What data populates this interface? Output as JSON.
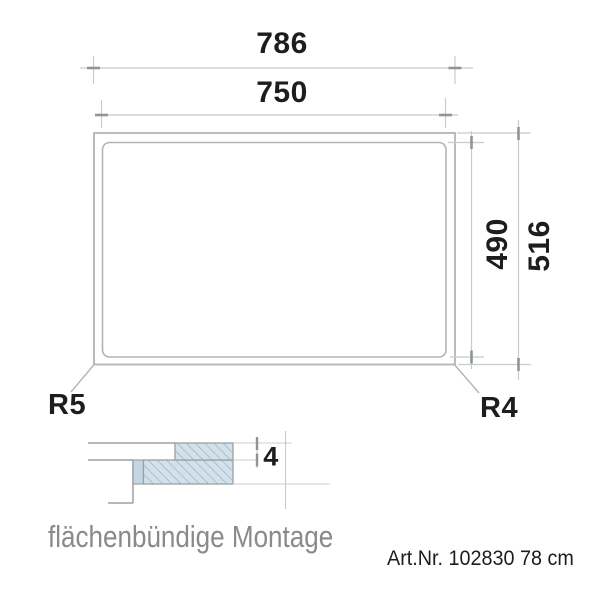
{
  "drawing": {
    "dim_outer_width": "786",
    "dim_cutout_width": "750",
    "dim_cutout_height": "490",
    "dim_outer_height": "516",
    "radius_left": "R5",
    "radius_right": "R4",
    "dim_glass_thickness": "4",
    "caption": "flächenbündige Montage",
    "art_no": "Art.Nr. 102830 78 cm"
  },
  "dimensions_mm": {
    "outer_width": 786,
    "cutout_width": 750,
    "cutout_height": 490,
    "outer_height": 516,
    "corner_radius_left": 5,
    "corner_radius_right": 4,
    "glass_thickness": 4
  },
  "colors": {
    "drawing_line": "#b1b5b8",
    "dim_line": "#c8cccf",
    "tick": "#8f9496",
    "section_line": "#9aa0a3",
    "hatch_fill": "#d3e1ea",
    "hatch_line": "#93abbd",
    "seal_fill": "#c3d7e3",
    "text": "#1d1d1b",
    "caption": "#8a8a8a"
  }
}
